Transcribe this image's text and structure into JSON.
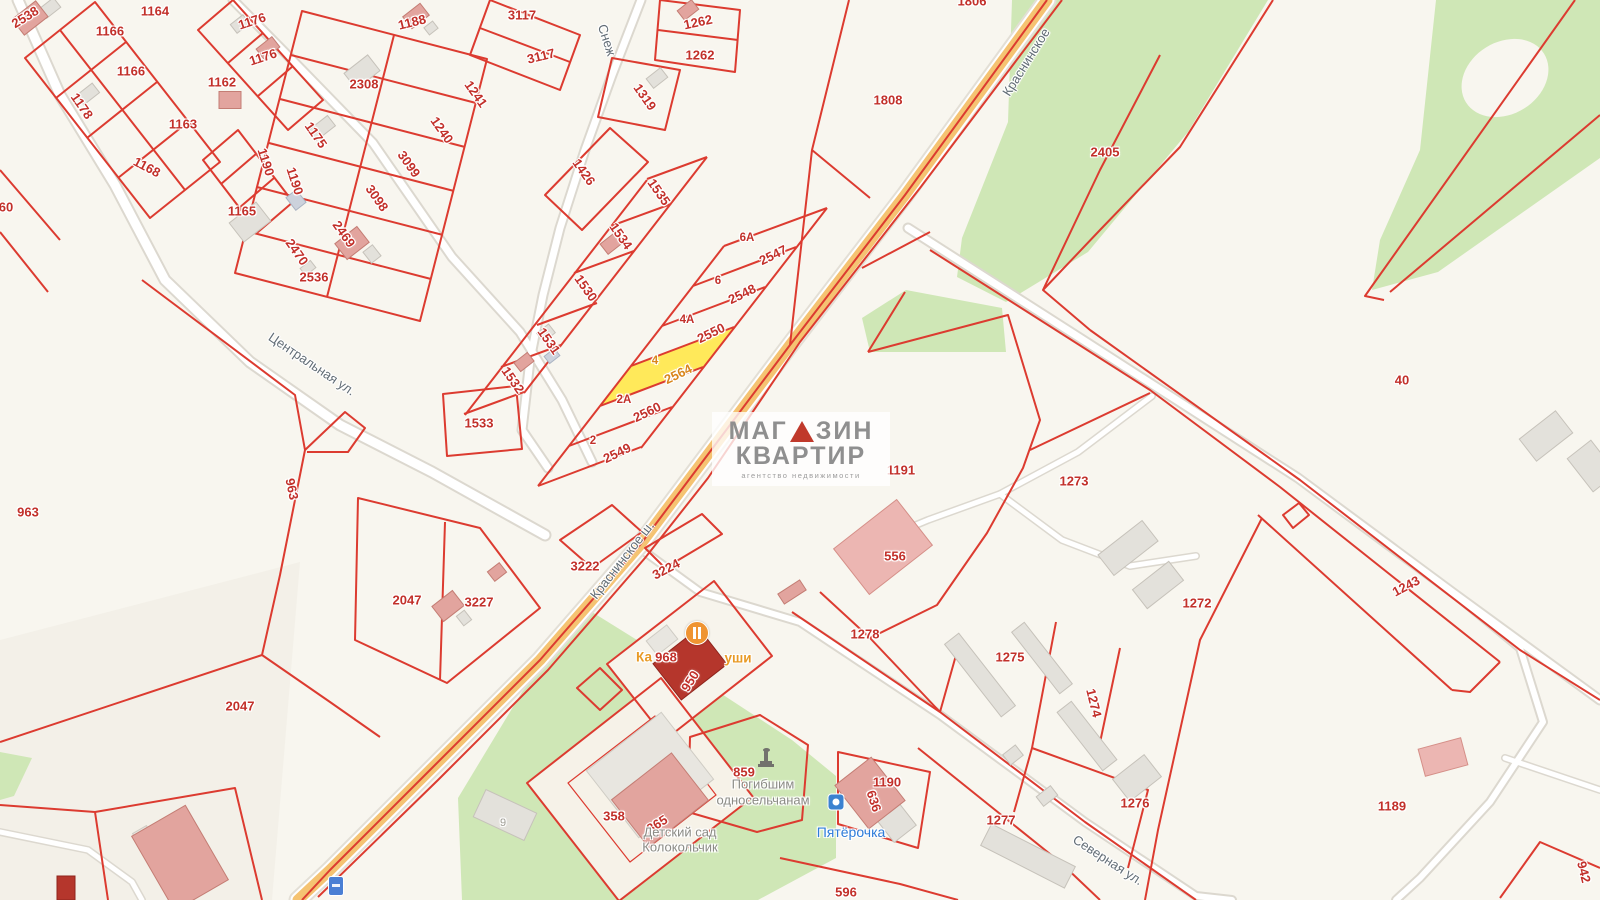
{
  "watermark": {
    "line1_left": "МАГ",
    "line1_right": "ЗИН",
    "line2": "КВАРТИР",
    "line3": "агентство недвижимости"
  },
  "colors": {
    "boundary_red": "#dc3b30",
    "highlight_parcel_fill": "#ffe95a",
    "green_area": "#cfe7b6",
    "road_orange": "#f5c372",
    "background": "#f8f6ef",
    "parcel_number": "#c2302a",
    "highlight_number": "#d9861c",
    "street_gray": "#626d76",
    "poi_blue": "#2e7cd9",
    "poi_orange": "#e89a25"
  },
  "highlighted_parcel": {
    "house_no": "4",
    "number": "2564"
  },
  "labels": [
    {
      "t": "2538",
      "x": 25,
      "y": 17,
      "r": -32,
      "k": "num"
    },
    {
      "t": "1164",
      "x": 155,
      "y": 11,
      "r": 0,
      "k": "num"
    },
    {
      "t": "1166",
      "x": 110,
      "y": 31,
      "r": 0,
      "k": "num"
    },
    {
      "t": "1166",
      "x": 131,
      "y": 71,
      "r": 0,
      "k": "num"
    },
    {
      "t": "1176",
      "x": 252,
      "y": 21,
      "r": -18,
      "k": "num"
    },
    {
      "t": "1176",
      "x": 263,
      "y": 57,
      "r": -18,
      "k": "num"
    },
    {
      "t": "1162",
      "x": 222,
      "y": 82,
      "r": 0,
      "k": "num"
    },
    {
      "t": "1178",
      "x": 82,
      "y": 106,
      "r": 55,
      "k": "num"
    },
    {
      "t": "1163",
      "x": 183,
      "y": 124,
      "r": 0,
      "k": "num"
    },
    {
      "t": "1168",
      "x": 147,
      "y": 167,
      "r": 28,
      "k": "num"
    },
    {
      "t": "1190",
      "x": 266,
      "y": 162,
      "r": 72,
      "k": "num"
    },
    {
      "t": "1190",
      "x": 295,
      "y": 181,
      "r": 72,
      "k": "num"
    },
    {
      "t": "1165",
      "x": 242,
      "y": 211,
      "r": 0,
      "k": "num"
    },
    {
      "t": "2308",
      "x": 364,
      "y": 84,
      "r": 0,
      "k": "num"
    },
    {
      "t": "1175",
      "x": 316,
      "y": 135,
      "r": 55,
      "k": "num"
    },
    {
      "t": "3099",
      "x": 409,
      "y": 164,
      "r": 55,
      "k": "num"
    },
    {
      "t": "3098",
      "x": 377,
      "y": 198,
      "r": 55,
      "k": "num"
    },
    {
      "t": "2469",
      "x": 344,
      "y": 234,
      "r": 55,
      "k": "num"
    },
    {
      "t": "2470",
      "x": 297,
      "y": 252,
      "r": 55,
      "k": "num"
    },
    {
      "t": "2536",
      "x": 314,
      "y": 277,
      "r": 0,
      "k": "num"
    },
    {
      "t": "1188",
      "x": 412,
      "y": 22,
      "r": -14,
      "k": "num"
    },
    {
      "t": "3117",
      "x": 522,
      "y": 15,
      "r": 0,
      "k": "num"
    },
    {
      "t": "3117",
      "x": 541,
      "y": 56,
      "r": -14,
      "k": "num"
    },
    {
      "t": "1241",
      "x": 476,
      "y": 94,
      "r": 55,
      "k": "num"
    },
    {
      "t": "1240",
      "x": 442,
      "y": 130,
      "r": 55,
      "k": "num"
    },
    {
      "t": "1426",
      "x": 584,
      "y": 172,
      "r": 55,
      "k": "num"
    },
    {
      "t": "1319",
      "x": 645,
      "y": 97,
      "r": 55,
      "k": "num"
    },
    {
      "t": "1535",
      "x": 659,
      "y": 192,
      "r": 55,
      "k": "num"
    },
    {
      "t": "1534",
      "x": 621,
      "y": 236,
      "r": 55,
      "k": "num"
    },
    {
      "t": "1530",
      "x": 586,
      "y": 288,
      "r": 55,
      "k": "num"
    },
    {
      "t": "1531",
      "x": 549,
      "y": 341,
      "r": 55,
      "k": "num"
    },
    {
      "t": "1532",
      "x": 513,
      "y": 380,
      "r": 55,
      "k": "num"
    },
    {
      "t": "1533",
      "x": 479,
      "y": 423,
      "r": 0,
      "k": "num"
    },
    {
      "t": "1262",
      "x": 698,
      "y": 22,
      "r": -12,
      "k": "num"
    },
    {
      "t": "1262",
      "x": 700,
      "y": 55,
      "r": 0,
      "k": "num"
    },
    {
      "t": "1806",
      "x": 972,
      "y": 1,
      "r": 0,
      "k": "num"
    },
    {
      "t": "1808",
      "x": 888,
      "y": 100,
      "r": 0,
      "k": "num"
    },
    {
      "t": "2405",
      "x": 1105,
      "y": 152,
      "r": 0,
      "k": "num"
    },
    {
      "t": "40",
      "x": 1402,
      "y": 380,
      "r": 0,
      "k": "num"
    },
    {
      "t": "6А",
      "x": 747,
      "y": 238,
      "r": 0,
      "k": "hnum"
    },
    {
      "t": "2547",
      "x": 773,
      "y": 255,
      "r": -26,
      "k": "num"
    },
    {
      "t": "6",
      "x": 718,
      "y": 281,
      "r": 0,
      "k": "hnum"
    },
    {
      "t": "2548",
      "x": 742,
      "y": 294,
      "r": -26,
      "k": "num"
    },
    {
      "t": "4А",
      "x": 687,
      "y": 320,
      "r": 0,
      "k": "hnum"
    },
    {
      "t": "2550",
      "x": 711,
      "y": 333,
      "r": -26,
      "k": "num"
    },
    {
      "t": "4",
      "x": 655,
      "y": 361,
      "r": 0,
      "k": "hnumo"
    },
    {
      "t": "2564",
      "x": 678,
      "y": 374,
      "r": -26,
      "k": "numo"
    },
    {
      "t": "2А",
      "x": 624,
      "y": 400,
      "r": 0,
      "k": "hnum"
    },
    {
      "t": "2560",
      "x": 647,
      "y": 412,
      "r": -26,
      "k": "num"
    },
    {
      "t": "2",
      "x": 593,
      "y": 441,
      "r": 0,
      "k": "hnum"
    },
    {
      "t": "2549",
      "x": 617,
      "y": 453,
      "r": -26,
      "k": "num"
    },
    {
      "t": "963",
      "x": 28,
      "y": 512,
      "r": 0,
      "k": "num"
    },
    {
      "t": "963",
      "x": 292,
      "y": 489,
      "r": 78,
      "k": "num"
    },
    {
      "t": "60",
      "x": 6,
      "y": 207,
      "r": 0,
      "k": "num"
    },
    {
      "t": "2047",
      "x": 407,
      "y": 600,
      "r": 0,
      "k": "num"
    },
    {
      "t": "3227",
      "x": 479,
      "y": 602,
      "r": 0,
      "k": "num"
    },
    {
      "t": "3222",
      "x": 585,
      "y": 566,
      "r": 0,
      "k": "num"
    },
    {
      "t": "3224",
      "x": 666,
      "y": 569,
      "r": -28,
      "k": "num"
    },
    {
      "t": "968",
      "x": 666,
      "y": 657,
      "r": 0,
      "k": "num"
    },
    {
      "t": "950",
      "x": 690,
      "y": 681,
      "r": -58,
      "k": "num"
    },
    {
      "t": "2047",
      "x": 240,
      "y": 706,
      "r": 0,
      "k": "num"
    },
    {
      "t": "556",
      "x": 895,
      "y": 556,
      "r": 0,
      "k": "num"
    },
    {
      "t": "1191",
      "x": 901,
      "y": 470,
      "r": 0,
      "k": "num"
    },
    {
      "t": "1273",
      "x": 1074,
      "y": 481,
      "r": 0,
      "k": "num"
    },
    {
      "t": "1278",
      "x": 865,
      "y": 634,
      "r": 0,
      "k": "num"
    },
    {
      "t": "1272",
      "x": 1197,
      "y": 603,
      "r": 0,
      "k": "num"
    },
    {
      "t": "1275",
      "x": 1010,
      "y": 657,
      "r": 0,
      "k": "num"
    },
    {
      "t": "1274",
      "x": 1094,
      "y": 703,
      "r": 76,
      "k": "num"
    },
    {
      "t": "1243",
      "x": 1406,
      "y": 586,
      "r": -28,
      "k": "num"
    },
    {
      "t": "1276",
      "x": 1135,
      "y": 803,
      "r": 0,
      "k": "num"
    },
    {
      "t": "1277",
      "x": 1001,
      "y": 820,
      "r": 0,
      "k": "num"
    },
    {
      "t": "1189",
      "x": 1392,
      "y": 806,
      "r": 0,
      "k": "num"
    },
    {
      "t": "1190",
      "x": 887,
      "y": 782,
      "r": 0,
      "k": "num"
    },
    {
      "t": "636",
      "x": 874,
      "y": 801,
      "r": 72,
      "k": "num"
    },
    {
      "t": "596",
      "x": 846,
      "y": 892,
      "r": 0,
      "k": "num"
    },
    {
      "t": "358",
      "x": 614,
      "y": 816,
      "r": 0,
      "k": "num"
    },
    {
      "t": "865",
      "x": 657,
      "y": 824,
      "r": -32,
      "k": "num"
    },
    {
      "t": "859",
      "x": 744,
      "y": 772,
      "r": 0,
      "k": "num"
    },
    {
      "t": "942",
      "x": 1584,
      "y": 872,
      "r": 76,
      "k": "num"
    },
    {
      "t": "9",
      "x": 503,
      "y": 823,
      "r": 0,
      "k": "bnum"
    },
    {
      "t": "Центральная ул.",
      "x": 312,
      "y": 364,
      "r": 34,
      "k": "street"
    },
    {
      "t": "Снеж",
      "x": 607,
      "y": 40,
      "r": 72,
      "k": "street"
    },
    {
      "t": "Краснинское",
      "x": 1026,
      "y": 62,
      "r": -58,
      "k": "street"
    },
    {
      "t": "Краснинское ш.",
      "x": 622,
      "y": 560,
      "r": -52,
      "k": "street"
    },
    {
      "t": "Северная ул.",
      "x": 1108,
      "y": 860,
      "r": 33,
      "k": "street"
    },
    {
      "t": "Ка",
      "x": 644,
      "y": 657,
      "r": 0,
      "k": "poio"
    },
    {
      "t": "уши",
      "x": 738,
      "y": 658,
      "r": 0,
      "k": "poio"
    },
    {
      "t": "Погибшим",
      "x": 763,
      "y": 784,
      "r": 0,
      "k": "poig"
    },
    {
      "t": "односельчанам",
      "x": 763,
      "y": 800,
      "r": 0,
      "k": "poig"
    },
    {
      "t": "Детский сад",
      "x": 680,
      "y": 832,
      "r": 0,
      "k": "poig"
    },
    {
      "t": "Колокольчик",
      "x": 680,
      "y": 847,
      "r": 0,
      "k": "poig"
    },
    {
      "t": "Пятёрочка",
      "x": 851,
      "y": 832,
      "r": 0,
      "k": "poib"
    }
  ],
  "icons": [
    {
      "name": "cafe-icon",
      "x": 697,
      "y": 633
    },
    {
      "name": "memorial-icon",
      "x": 766,
      "y": 758
    },
    {
      "name": "pyaterochka-icon",
      "x": 836,
      "y": 802
    },
    {
      "name": "route-shield-icon",
      "x": 336,
      "y": 886
    }
  ]
}
